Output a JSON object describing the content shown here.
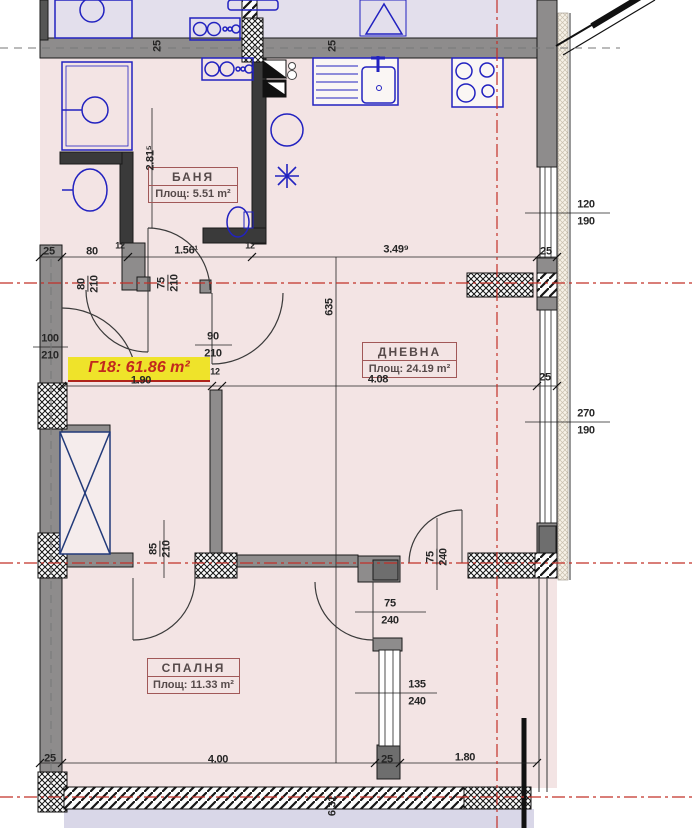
{
  "apartment": {
    "label": "Г18: 61.86 m²"
  },
  "rooms": [
    {
      "name": "БАНЯ",
      "area": "Площ: 5.51 m²"
    },
    {
      "name": "ДНЕВНА",
      "area": "Площ: 24.19 m²"
    },
    {
      "name": "СПАЛНЯ",
      "area": "Площ: 11.33 m²"
    }
  ],
  "dimensions": [
    {
      "t": "25",
      "x": 158,
      "y": 46,
      "rot": true
    },
    {
      "t": "25",
      "x": 333,
      "y": 46,
      "rot": true
    },
    {
      "t": "2.81⁵",
      "x": 151,
      "y": 158,
      "rot": true
    },
    {
      "t": "25",
      "x": 49,
      "y": 252
    },
    {
      "t": "80",
      "x": 92,
      "y": 252
    },
    {
      "t": "1.56¹",
      "x": 186,
      "y": 251
    },
    {
      "t": "3.49⁹",
      "x": 396,
      "y": 250
    },
    {
      "t": "25",
      "x": 546,
      "y": 252
    },
    {
      "t": "120",
      "x": 586,
      "y": 205
    },
    {
      "t": "190",
      "x": 586,
      "y": 222
    },
    {
      "t": "270",
      "x": 586,
      "y": 414
    },
    {
      "t": "190",
      "x": 586,
      "y": 431
    },
    {
      "t": "635",
      "x": 330,
      "y": 307,
      "rot": true
    },
    {
      "pair": [
        "80",
        "210"
      ],
      "x": 88,
      "y": 284,
      "rot": true
    },
    {
      "pair": [
        "75",
        "210"
      ],
      "x": 168,
      "y": 283,
      "rot": true
    },
    {
      "t": "100",
      "x": 50,
      "y": 339
    },
    {
      "t": "210",
      "x": 50,
      "y": 356
    },
    {
      "t": "90",
      "x": 213,
      "y": 337
    },
    {
      "t": "210",
      "x": 213,
      "y": 354
    },
    {
      "t": "12",
      "x": 120,
      "y": 246,
      "small": true
    },
    {
      "t": "12",
      "x": 250,
      "y": 246,
      "small": true
    },
    {
      "t": "12",
      "x": 215,
      "y": 372,
      "small": true
    },
    {
      "t": "1.90",
      "x": 141,
      "y": 381
    },
    {
      "t": "4.08",
      "x": 378,
      "y": 380
    },
    {
      "t": "25",
      "x": 545,
      "y": 378
    },
    {
      "pair": [
        "85",
        "210"
      ],
      "x": 160,
      "y": 549,
      "rot": true
    },
    {
      "pair": [
        "75",
        "240"
      ],
      "x": 437,
      "y": 557,
      "rot": true
    },
    {
      "t": "75",
      "x": 390,
      "y": 604
    },
    {
      "t": "240",
      "x": 390,
      "y": 621
    },
    {
      "t": "135",
      "x": 417,
      "y": 685
    },
    {
      "t": "240",
      "x": 417,
      "y": 702
    },
    {
      "t": "25",
      "x": 50,
      "y": 759
    },
    {
      "t": "4.00",
      "x": 218,
      "y": 760
    },
    {
      "t": "25",
      "x": 387,
      "y": 760
    },
    {
      "t": "1.80",
      "x": 465,
      "y": 758
    },
    {
      "t": "6.31",
      "x": 333,
      "y": 806,
      "rot": true
    }
  ],
  "colors": {
    "floor": "#f3e4e4",
    "neighbor_top": "#e3dfec",
    "neighbor_bottom": "#d9d7e8",
    "wall_gray": "#8e8c8c",
    "fixture_blue": "#2222c0",
    "axis_red": "#c23028",
    "highlight_yellow": "#efe32a",
    "highlight_text": "#c2281e",
    "label_border": "#a15858",
    "dim_text": "#262626"
  }
}
